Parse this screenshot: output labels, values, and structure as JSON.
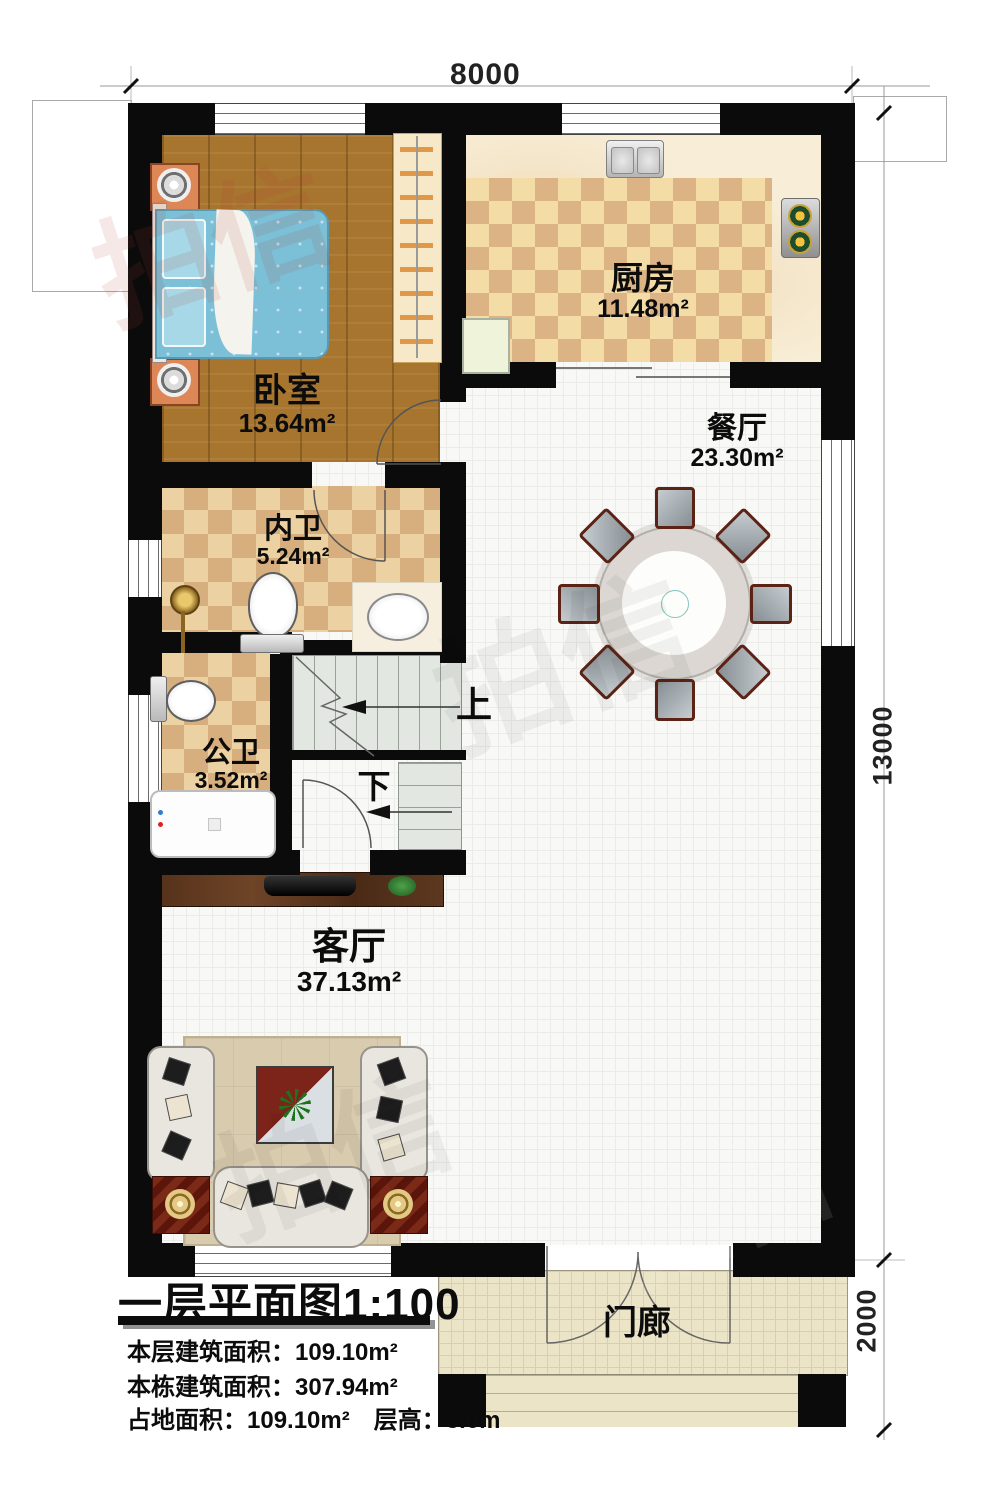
{
  "image_type": "residential floor plan, first storey",
  "dims": {
    "width": "8000",
    "height_main": "13000",
    "porch": "2000"
  },
  "rooms": [
    {
      "name": "卧室",
      "area": "13.64m²"
    },
    {
      "name": "厨房",
      "area": "11.48m²"
    },
    {
      "name": "餐厅",
      "area": "23.30m²"
    },
    {
      "name": "内卫",
      "area": "5.24m²"
    },
    {
      "name": "公卫",
      "area": "3.52m²"
    },
    {
      "name": "客厅",
      "area": "37.13m²"
    },
    {
      "name": "门廊",
      "area": ""
    }
  ],
  "stairs": {
    "up": "上",
    "down": "下"
  },
  "title_block": {
    "title": "一层平面图1:100",
    "lines": [
      "本层建筑面积：109.10m²",
      "本栋建筑面积：307.94m²",
      "占地面积：109.10m²　层高：3.6m"
    ]
  },
  "watermark": {
    "text": "拍信"
  },
  "palette": {
    "wall": "#0b0b0b",
    "wood_floor": "#a8752f",
    "checker_light": "#f4dca6",
    "checker_dark": "#d9b183",
    "tile_floor": "#f8f8f6",
    "porch_floor": "#ece4c6",
    "bed_blue": "#7cc0d8",
    "stair_green": "#e2e8e1"
  }
}
